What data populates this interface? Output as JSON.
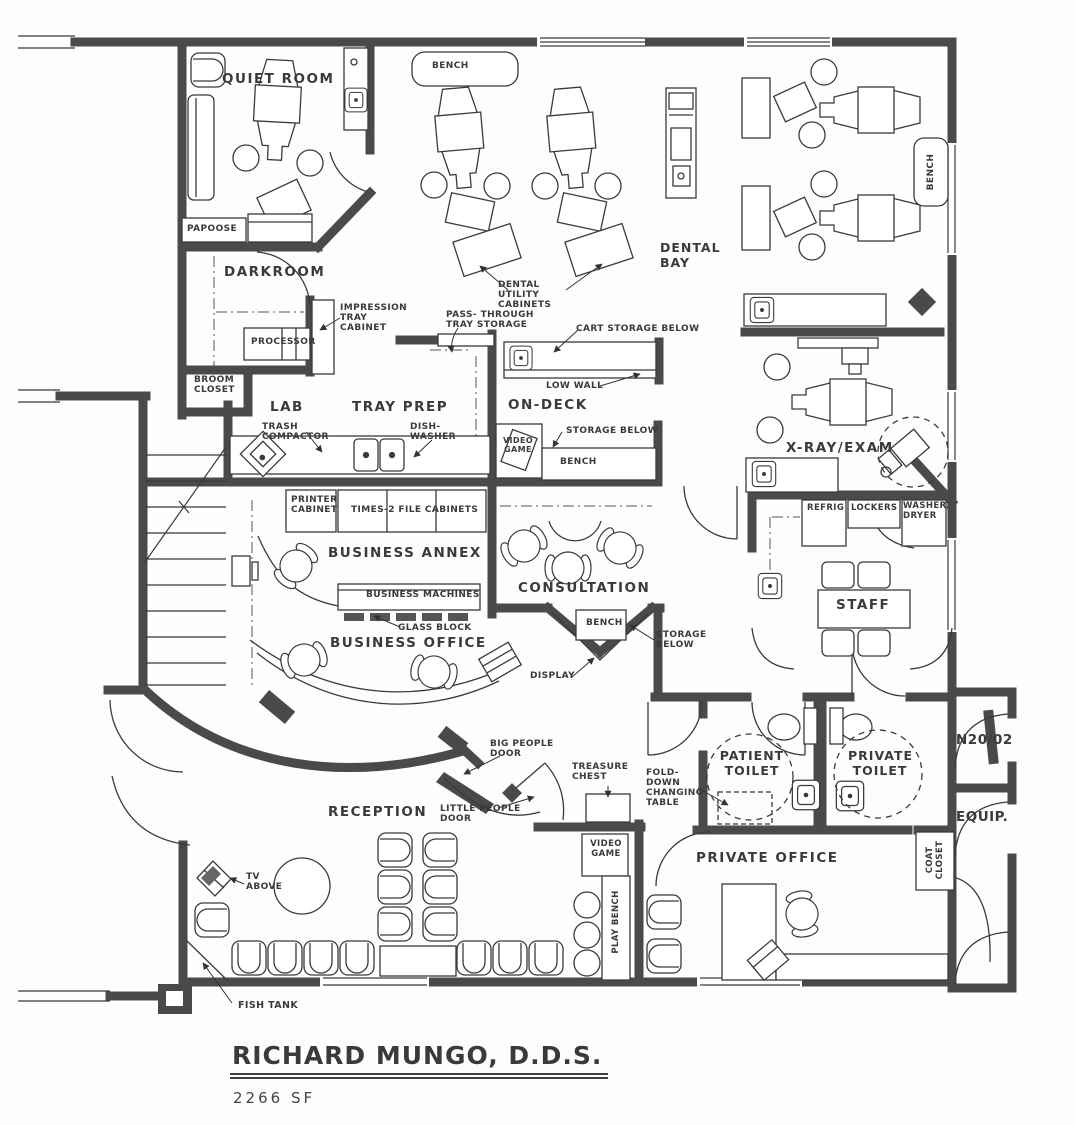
{
  "title": {
    "name": "RICHARD MUNGO, D.D.S.",
    "area": "2266 SF"
  },
  "rooms": {
    "quiet_room": "QUIET ROOM",
    "darkroom": "DARKROOM",
    "dental_bay": "DENTAL BAY",
    "lab": "LAB",
    "tray_prep": "TRAY PREP",
    "on_deck": "ON-DECK",
    "x_ray_exam": "X-RAY/EXAM",
    "business_annex": "BUSINESS ANNEX",
    "business_office": "BUSINESS OFFICE",
    "consultation": "CONSULTATION",
    "staff": "STAFF",
    "reception": "RECEPTION",
    "patient_toilet": "PATIENT TOILET",
    "private_toilet": "PRIVATE TOILET",
    "nitrous": "N20/02",
    "equip": "EQUIP.",
    "private_office": "PRIVATE OFFICE"
  },
  "fixtures": {
    "papoose": "PAPOOSE",
    "bench": "BENCH",
    "processor": "PROCESSOR",
    "impression_tray_cabinet": "IMPRESSION TRAY CABINET",
    "broom_closet": "BROOM CLOSET",
    "trash_compactor": "TRASH COMPACTOR",
    "dish_washer": "DISH- WASHER",
    "pass_through": "PASS- THROUGH TRAY STORAGE",
    "dental_utility_cabinets": "DENTAL UTILITY CABINETS",
    "cart_storage": "CART STORAGE BELOW",
    "low_wall": "LOW WALL",
    "video_game": "VIDEO GAME",
    "storage_below": "STORAGE BELOW",
    "refrig": "REFRIG",
    "lockers": "LOCKERS",
    "washer_dryer": "WASHER/ DRYER",
    "printer_cabinet": "PRINTER CABINET",
    "file_cabinets": "TIMES-2 FILE CABINETS",
    "business_machines": "BUSINESS MACHINES",
    "glass_block": "GLASS BLOCK",
    "display": "DISPLAY",
    "big_people_door": "BIG PEOPLE DOOR",
    "little_people_door": "LITTLE PEOPLE DOOR",
    "treasure_chest": "TREASURE CHEST",
    "fold_down_changing_table": "FOLD-DOWN CHANGING TABLE",
    "tv_above": "TV ABOVE",
    "play_bench": "PLAY BENCH",
    "coat_closet": "COAT CLOSET",
    "fish_tank": "FISH TANK"
  }
}
